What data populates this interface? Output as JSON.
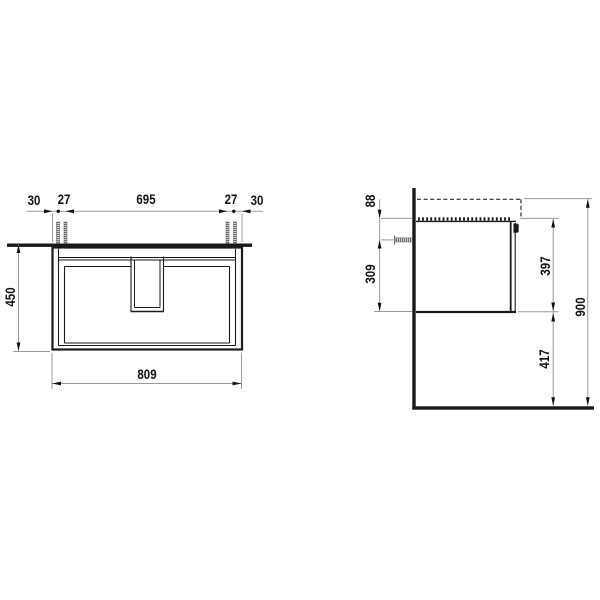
{
  "front_view": {
    "dims": {
      "overhang_left": "30",
      "pitch_left": "27",
      "span_center": "695",
      "pitch_right": "27",
      "overhang_right": "30",
      "cabinet_height": "450",
      "cabinet_width": "809"
    }
  },
  "side_view": {
    "dims": {
      "top_offset": "88",
      "anchor_to_bottom": "309",
      "body_height": "397",
      "floor_clearance": "417",
      "overall_height": "900"
    }
  },
  "colors": {
    "object_line": "#1a1a1a",
    "dimension_line": "#9a9a9a",
    "text": "#111111",
    "background": "#ffffff"
  }
}
